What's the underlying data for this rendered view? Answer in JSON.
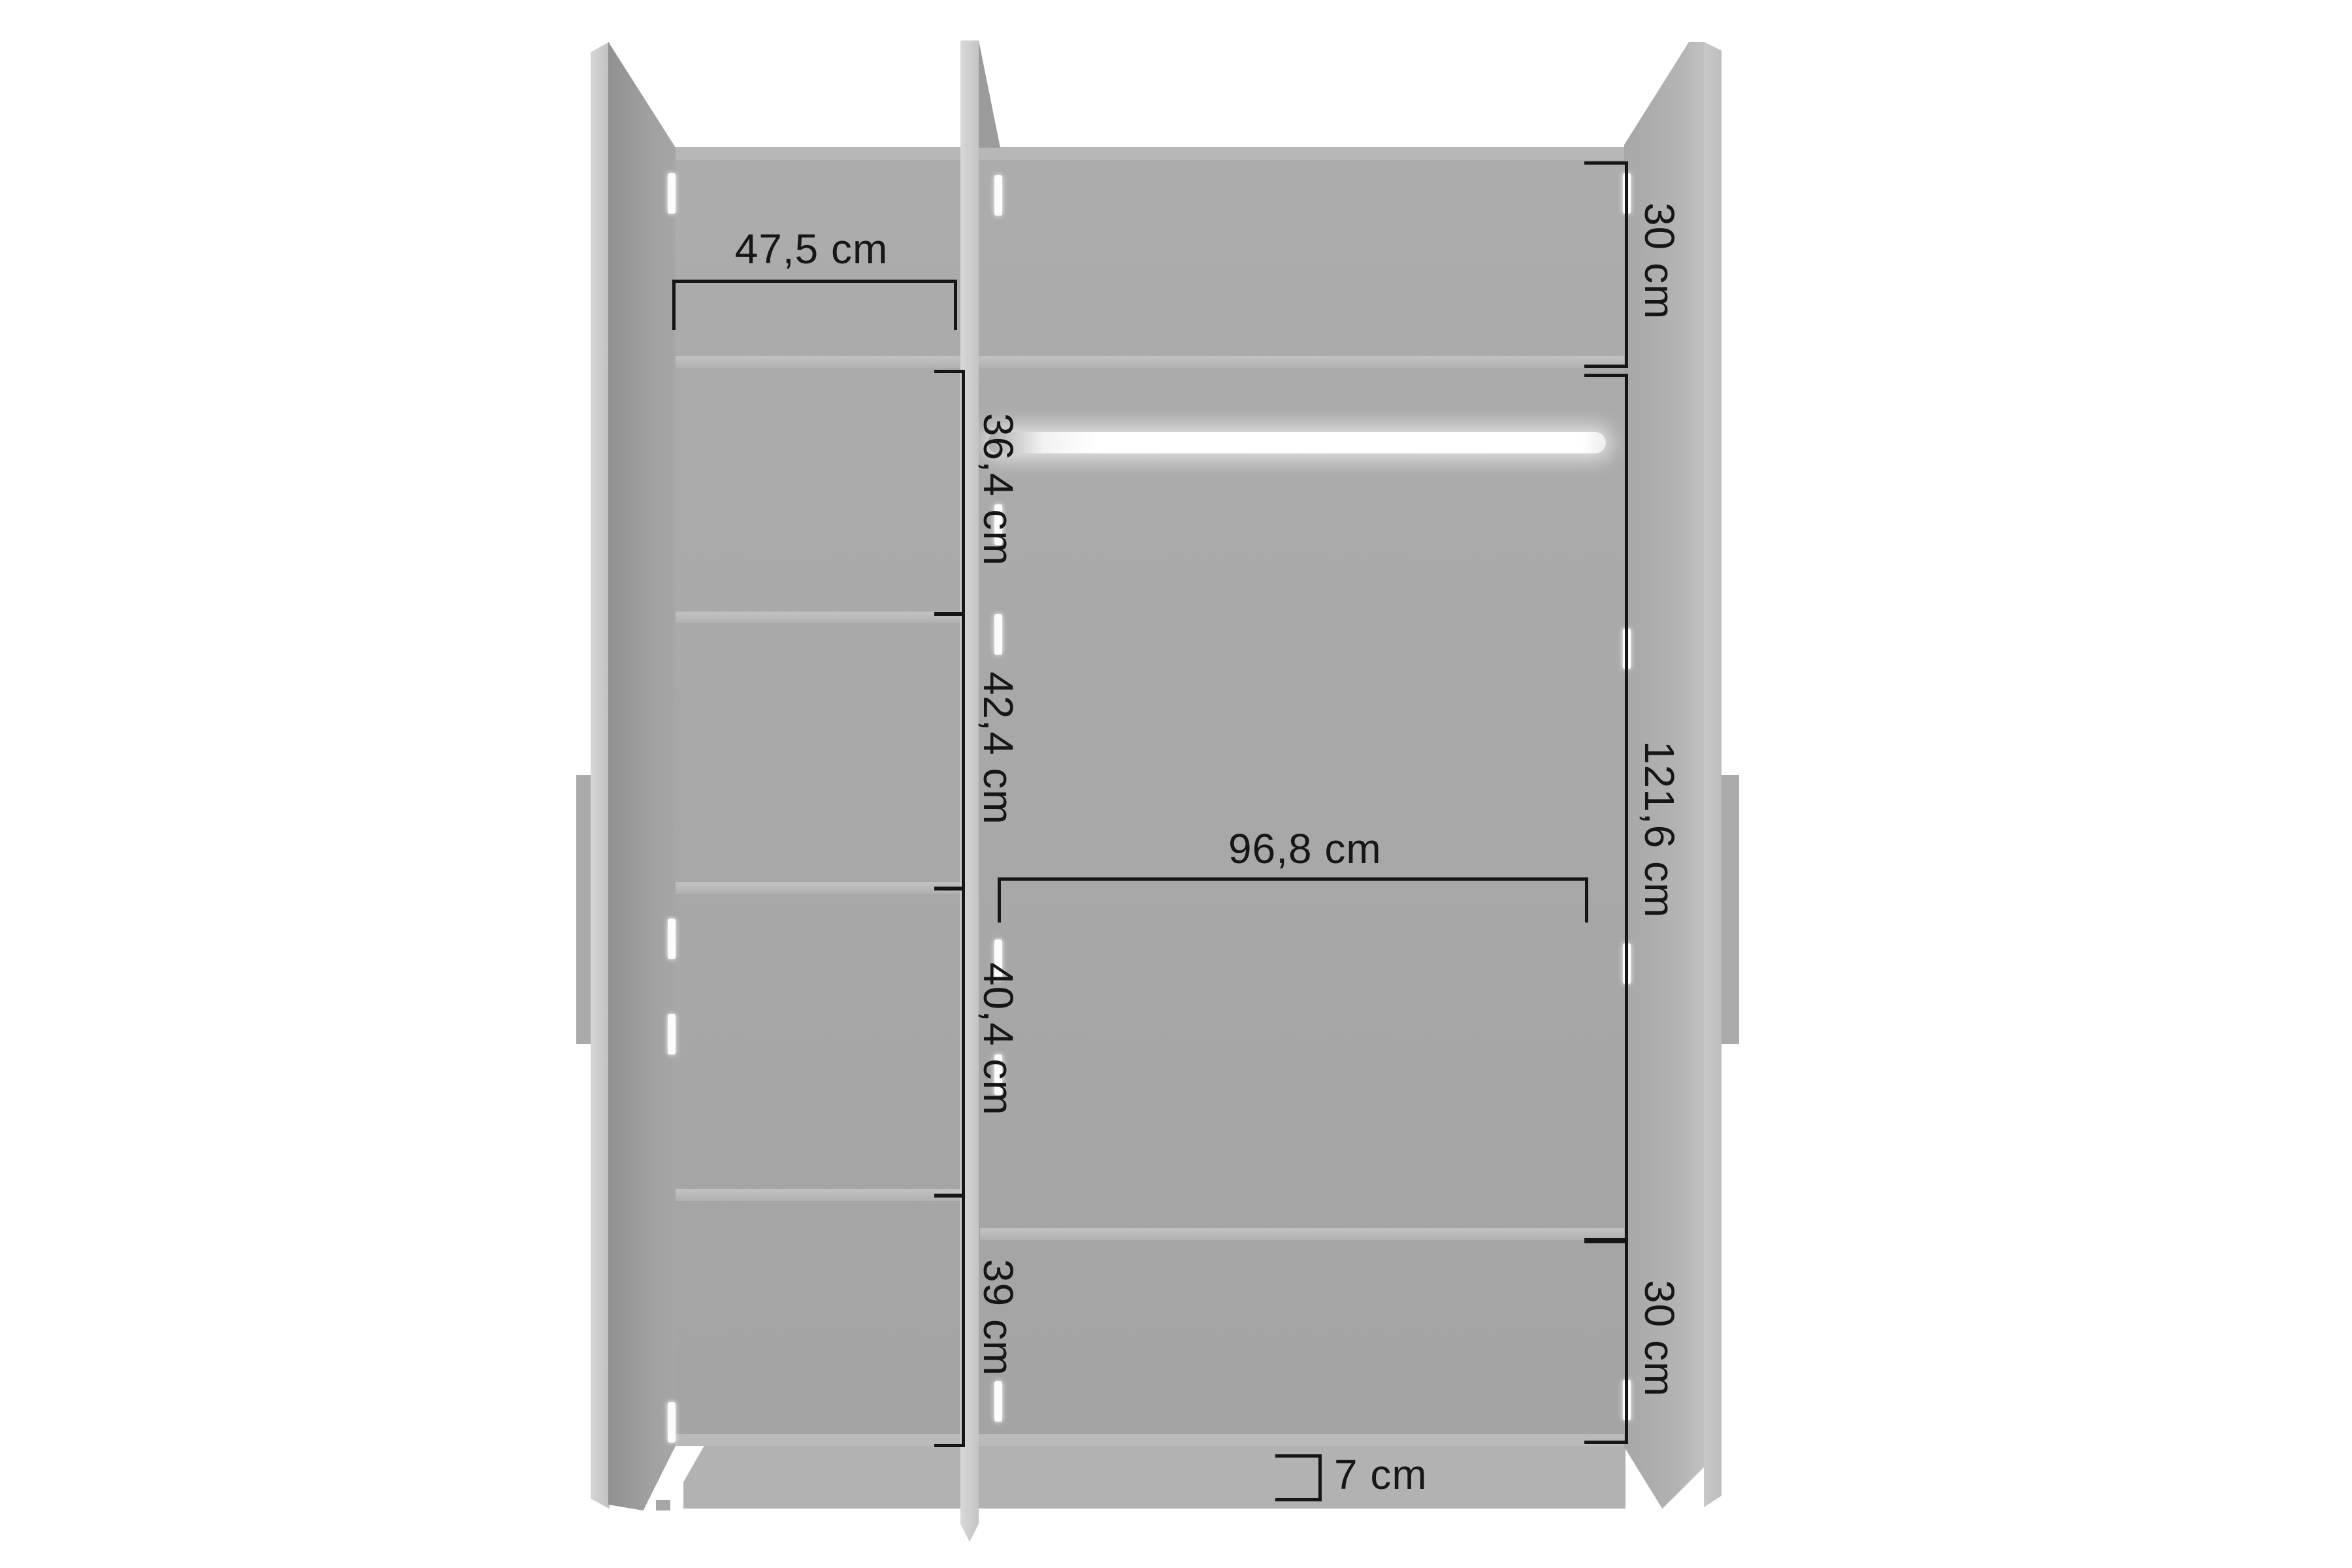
{
  "diagram": {
    "kind": "wardrobe-interior-dimension-drawing",
    "unit": "cm",
    "colors": {
      "background": "#ffffff",
      "ink": "#161616",
      "cabinet_gray": "#a8a8a8",
      "panel_light_gray": "#c9c9c9",
      "shelf_light_gray": "#bcbcbc",
      "door_gray": "#9e9e9e",
      "plinth_gray": "#b2b2b2",
      "rod_white": "#ffffff"
    },
    "dimensions": {
      "shelf_width": {
        "label": "47,5 cm",
        "value_cm": 47.5
      },
      "left_gap_1": {
        "label": "36,4 cm",
        "value_cm": 36.4
      },
      "left_gap_2": {
        "label": "42,4 cm",
        "value_cm": 42.4
      },
      "left_gap_3": {
        "label": "40,4 cm",
        "value_cm": 40.4
      },
      "left_gap_4": {
        "label": "39 cm",
        "value_cm": 39
      },
      "right_top_shelf": {
        "label": "30 cm",
        "value_cm": 30
      },
      "hanging_height": {
        "label": "121,6 cm",
        "value_cm": 121.6
      },
      "right_bottom_shelf": {
        "label": "30 cm",
        "value_cm": 30
      },
      "hanging_width": {
        "label": "96,8 cm",
        "value_cm": 96.8
      },
      "plinth_height": {
        "label": "7 cm",
        "value_cm": 7
      }
    }
  }
}
